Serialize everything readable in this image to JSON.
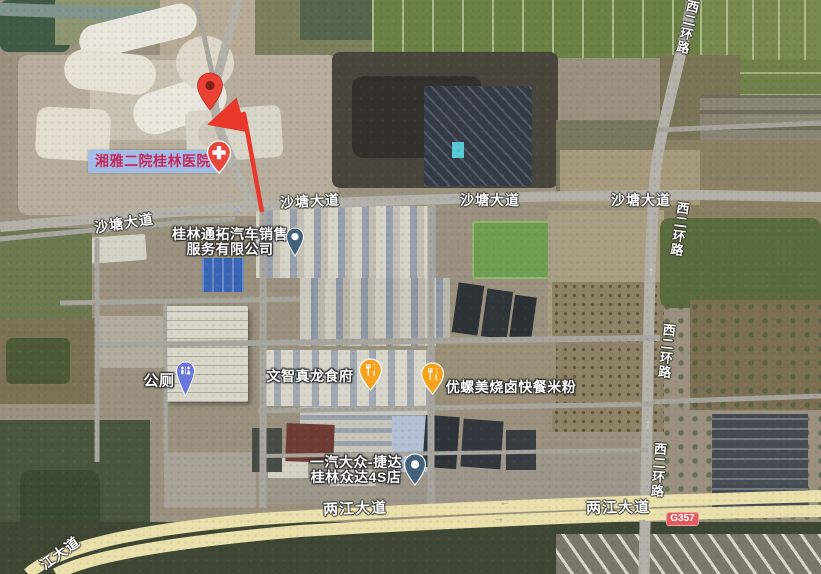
{
  "map": {
    "road_labels": [
      {
        "text": "沙塘大道"
      },
      {
        "text": "沙塘大道"
      },
      {
        "text": "沙塘大道"
      },
      {
        "text": "沙塘大道"
      },
      {
        "text": "两江大道"
      },
      {
        "text": "两江大道"
      },
      {
        "text": "江大道"
      },
      {
        "text": "西二环路"
      },
      {
        "text": "西二环路"
      },
      {
        "text": "西二环路"
      },
      {
        "text": "西二环路"
      }
    ],
    "pois": [
      {
        "line1": "桂林通拓汽车销售",
        "line2": "服务有限公司",
        "pin": "blue-dot-pin"
      },
      {
        "line1": "文智真龙食府",
        "pin": "restaurant-pin"
      },
      {
        "line1": "优螺美烧卤快餐米粉",
        "pin": "restaurant-pin"
      },
      {
        "line1": "一汽大众-捷达",
        "line2": "桂林众达4S店",
        "pin": "blue-dot-pin"
      },
      {
        "line1": "公厕",
        "pin": "restroom-pin"
      }
    ],
    "highlighted_place": {
      "text": "湘雅二院桂林医院"
    },
    "route_badge": {
      "text": "G357"
    },
    "direction_arrows": [
      {
        "glyph": "←"
      },
      {
        "glyph": "→"
      },
      {
        "glyph": "→"
      },
      {
        "glyph": "↓"
      },
      {
        "glyph": "↑"
      },
      {
        "glyph": "↑"
      },
      {
        "glyph": "←"
      },
      {
        "glyph": "→"
      },
      {
        "glyph": "→"
      }
    ],
    "colors": {
      "destination_pin": "#ea4335",
      "destination_pin_dot": "#7e2217",
      "hospital_pin": "#e8463a",
      "restaurant_pin": "#f6a21d",
      "blue_dot_pin": "#44617c",
      "restroom_pin": "#6a76dc",
      "route_arrow": "#e8382b",
      "highlight_bg": "#a2bde9",
      "highlight_text": "#c5295a",
      "badge_bg": "#e25c5f",
      "badge_text": "#ffffff"
    }
  }
}
